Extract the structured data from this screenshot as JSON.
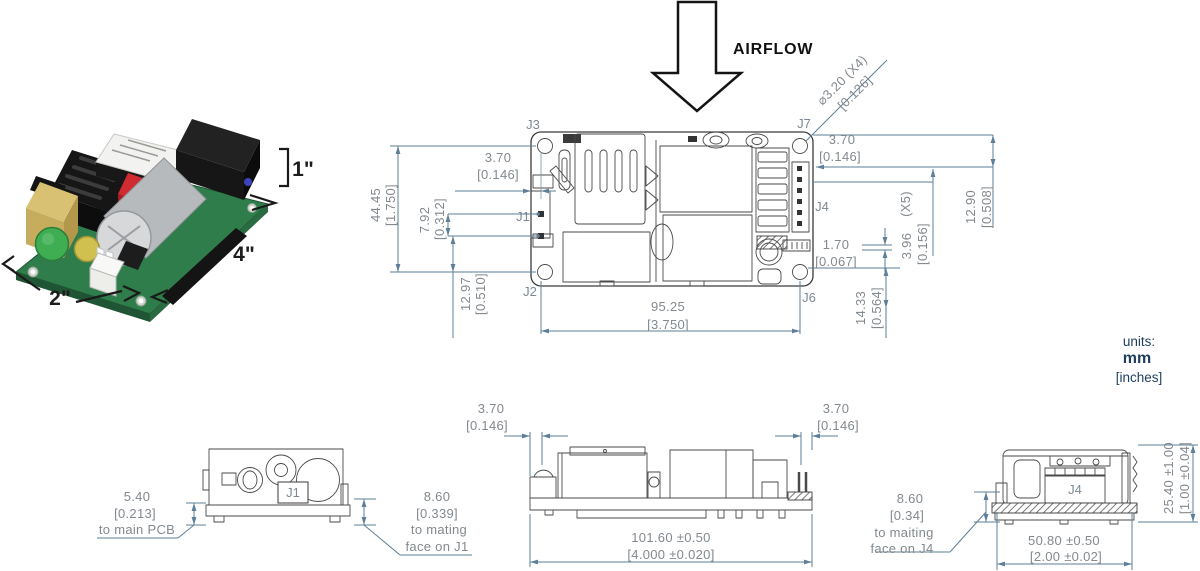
{
  "product_photo": {
    "height_label": "1\"",
    "length_label": "4\"",
    "width_label": "2\""
  },
  "airflow": {
    "label": "AIRFLOW"
  },
  "units_note": {
    "title": "units:",
    "primary": "mm",
    "secondary": "[inches]"
  },
  "top_view": {
    "connector_labels": {
      "j1": "J1",
      "j2": "J2",
      "j3": "J3",
      "j4": "J4",
      "j6": "J6",
      "j7": "J7"
    },
    "dims": {
      "hole_span_v": {
        "mm": "44.45",
        "in": "[1.750]"
      },
      "left_edge_offset": {
        "mm": "3.70",
        "in": "[0.146]"
      },
      "j1_pin_pitch": {
        "mm": "7.92",
        "in": "[0.312]"
      },
      "j1_to_hole": {
        "mm": "12.97",
        "in": "[0.510]"
      },
      "mounting_hole_dia": {
        "mm": "⌀3.20 (X4)",
        "in": "[0.126]"
      },
      "right_edge_offset": {
        "mm": "3.70",
        "in": "[0.146]"
      },
      "hole_to_pin": {
        "mm": "12.90",
        "in": "[0.508]"
      },
      "j4_pin_pitch": {
        "mm": "3.96",
        "count": "(X5)",
        "in": "[0.156]"
      },
      "aux_pin_offset": {
        "mm": "1.70",
        "in": "[0.067]"
      },
      "pin_to_hole": {
        "mm": "14.33",
        "in": "[0.564]"
      },
      "hole_span_h": {
        "mm": "95.25",
        "in": "[3.750]"
      }
    }
  },
  "side_view_j1": {
    "connector_label": "J1",
    "dims": {
      "standoff": {
        "mm": "5.40",
        "in": "[0.213]",
        "note": "to main PCB"
      },
      "mating_height": {
        "mm": "8.60",
        "in": "[0.339]",
        "note_line1": "to mating",
        "note_line2": "face on J1"
      }
    }
  },
  "side_view_long": {
    "dims": {
      "left_overhang": {
        "mm": "3.70",
        "in": "[0.146]"
      },
      "right_overhang": {
        "mm": "3.70",
        "in": "[0.146]"
      },
      "overall_length": {
        "mm": "101.60 ±0.50",
        "in": "[4.000 ±0.020]"
      }
    }
  },
  "side_view_j4": {
    "connector_label": "J4",
    "dims": {
      "mating_height": {
        "mm": "8.60",
        "in": "[0.34]",
        "note_line1": "to maiting",
        "note_line2": "face on J4"
      },
      "overall_height": {
        "mm": "25.40 ±1.00",
        "in": "[1.00 ±0.04]"
      },
      "overall_width": {
        "mm": "50.80 ±0.50",
        "in": "[2.00 ±0.02]"
      }
    }
  }
}
